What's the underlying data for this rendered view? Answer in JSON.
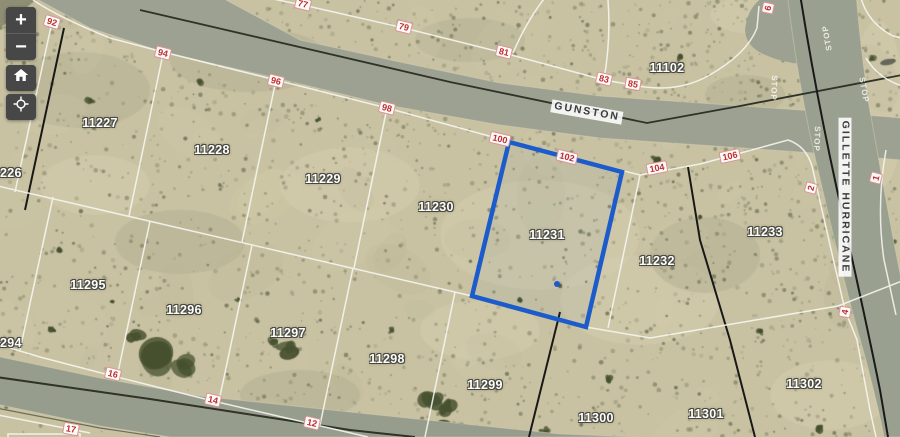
{
  "controls": {
    "zoom_in_label": "+",
    "zoom_out_label": "−"
  },
  "map": {
    "selected_parcel": "11231",
    "colors": {
      "highlight_blue": "#1b5bcb",
      "address_red": "#c22b2b"
    },
    "street_labels": [
      {
        "text": "GUNSTON",
        "x": 587,
        "y": 112,
        "rot": 10
      },
      {
        "text": "GILLETTE HURRICANE",
        "x": 845,
        "y": 197,
        "rot": 90
      }
    ],
    "parcel_labels": [
      {
        "text": "11227",
        "x": 100,
        "y": 123
      },
      {
        "text": "11228",
        "x": 212,
        "y": 150
      },
      {
        "text": "11229",
        "x": 323,
        "y": 179
      },
      {
        "text": "11230",
        "x": 436,
        "y": 207
      },
      {
        "text": "11231",
        "x": 547,
        "y": 235
      },
      {
        "text": "11232",
        "x": 657,
        "y": 261
      },
      {
        "text": "11233",
        "x": 765,
        "y": 232
      },
      {
        "text": "11102",
        "x": 667,
        "y": 68
      },
      {
        "text": "11295",
        "x": 88,
        "y": 285
      },
      {
        "text": "11296",
        "x": 184,
        "y": 310
      },
      {
        "text": "11297",
        "x": 288,
        "y": 333
      },
      {
        "text": "11298",
        "x": 387,
        "y": 359
      },
      {
        "text": "11299",
        "x": 485,
        "y": 385
      },
      {
        "text": "11300",
        "x": 596,
        "y": 418
      },
      {
        "text": "11301",
        "x": 706,
        "y": 414
      },
      {
        "text": "11302",
        "x": 804,
        "y": 384
      },
      {
        "text": "226",
        "x": 0,
        "y": 173,
        "edge": true
      },
      {
        "text": "294",
        "x": 0,
        "y": 343,
        "edge": true
      }
    ],
    "address_labels": [
      {
        "text": "92",
        "x": 52,
        "y": 22,
        "rot": 17
      },
      {
        "text": "94",
        "x": 163,
        "y": 53,
        "rot": 14
      },
      {
        "text": "96",
        "x": 276,
        "y": 81,
        "rot": 14
      },
      {
        "text": "98",
        "x": 387,
        "y": 108,
        "rot": 14
      },
      {
        "text": "100",
        "x": 500,
        "y": 139,
        "rot": 13
      },
      {
        "text": "102",
        "x": 567,
        "y": 157,
        "rot": 14
      },
      {
        "text": "104",
        "x": 657,
        "y": 168,
        "rot": -11
      },
      {
        "text": "106",
        "x": 730,
        "y": 156,
        "rot": -12
      },
      {
        "text": "77",
        "x": 303,
        "y": 4,
        "rot": 14
      },
      {
        "text": "79",
        "x": 404,
        "y": 27,
        "rot": 14
      },
      {
        "text": "81",
        "x": 504,
        "y": 52,
        "rot": 14
      },
      {
        "text": "83",
        "x": 604,
        "y": 79,
        "rot": 13
      },
      {
        "text": "85",
        "x": 633,
        "y": 84,
        "rot": 10
      },
      {
        "text": "16",
        "x": 113,
        "y": 374,
        "rot": 14
      },
      {
        "text": "14",
        "x": 213,
        "y": 400,
        "rot": 13
      },
      {
        "text": "12",
        "x": 312,
        "y": 423,
        "rot": 13
      },
      {
        "text": "17",
        "x": 71,
        "y": 429,
        "rot": 10
      },
      {
        "text": "2",
        "x": 811,
        "y": 188,
        "rot": -75
      },
      {
        "text": "1",
        "x": 876,
        "y": 178,
        "rot": -75
      },
      {
        "text": "6",
        "x": 768,
        "y": 8,
        "rot": -78
      },
      {
        "text": "4",
        "x": 845,
        "y": 312,
        "rot": -80
      }
    ],
    "road_markings": [
      {
        "text": "STOP",
        "x": 827,
        "y": 38,
        "rot": 260
      },
      {
        "text": "STOP",
        "x": 774,
        "y": 88,
        "rot": 92
      },
      {
        "text": "STOP",
        "x": 864,
        "y": 90,
        "rot": 80
      },
      {
        "text": "STOP",
        "x": 817,
        "y": 139,
        "rot": 92
      }
    ]
  }
}
